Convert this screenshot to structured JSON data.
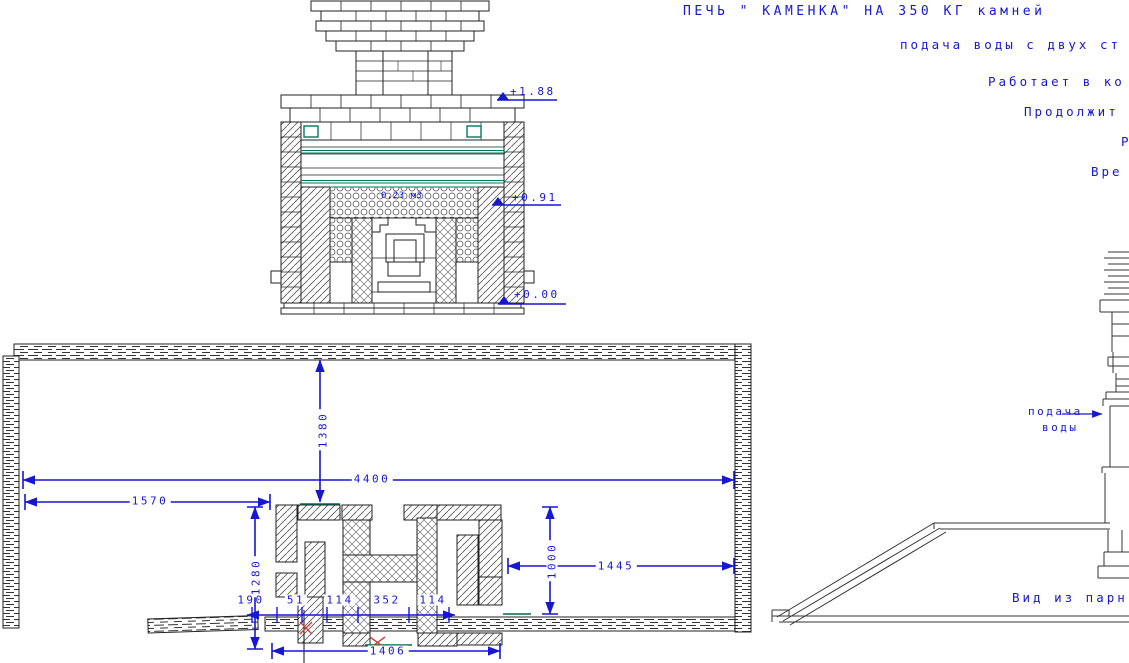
{
  "header": {
    "title": "ПЕЧЬ \" КАМЕНКА\" НА 350 КГ камней",
    "notes": [
      "подача воды с двух ст",
      "Работает в ко",
      "Продолжит",
      "Р",
      "Вре"
    ]
  },
  "front_view": {
    "levels": [
      "+1.88",
      "+0.91",
      "+0.00"
    ],
    "stones_note": "0,23 м3"
  },
  "plan_view": {
    "dim_width_total": "4400",
    "dim_left_offset": "1570",
    "dim_depth_inner": "1380",
    "dim_stove_depth": "1280",
    "dim_right_offset": "1445",
    "dim_stove_inner": "1000",
    "dim_stove_width": "1406",
    "dim_chain": [
      "190",
      "51",
      "114",
      "352",
      "114"
    ]
  },
  "perspective_view": {
    "water_supply": [
      "подача",
      "воды"
    ],
    "caption": "Вид из парн"
  },
  "colors": {
    "dim_blue": "#1717d2",
    "accent_teal": "#007a5e",
    "mark_red": "#cf3a3a"
  }
}
